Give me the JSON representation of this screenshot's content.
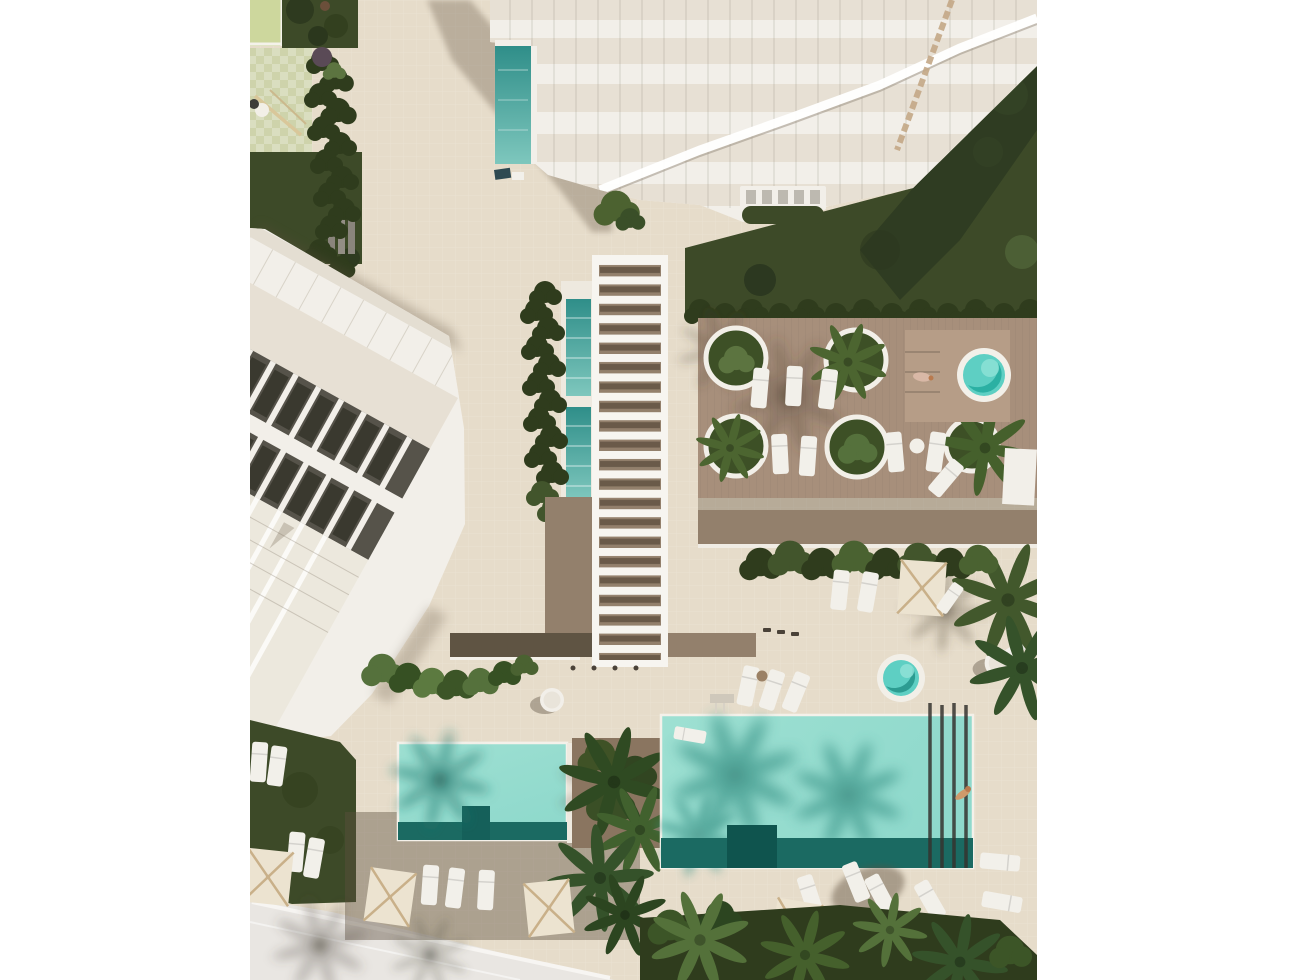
{
  "scene": {
    "type": "architectural-aerial-render",
    "description": "Top-down aerial 3D rendering of a coastal residential resort complex: a white high-rise tower with stepped terraces at the top, a long white row-house building on the left, a central white slatted pergola walkway flanked by two narrow lap pools and a hedge, a timber sun deck on the right with five round palm planters, sun loungers and a circular spa pool, a large turquoise main swimming pool and a smaller rectangular pool at the bottom surrounded by cream parasols, loungers, palm trees, lawns and a light street corner at the lower left. No text appears in the image.",
    "features": [
      {
        "name": "tower-building",
        "label": "White terraced high-rise tower, top of image"
      },
      {
        "name": "tower-pool",
        "label": "Narrow teal plunge pool beside tower"
      },
      {
        "name": "rowhouse-building",
        "label": "Diagonal white row-house block with dark grey roof decks, left side"
      },
      {
        "name": "pergola-walkway",
        "label": "White slatted pergola walkway, centre"
      },
      {
        "name": "lap-pools",
        "label": "Two narrow teal lap pools beside pergola",
        "count": 2
      },
      {
        "name": "wood-deck",
        "label": "Timber sun deck with round planters",
        "planter_count": 5
      },
      {
        "name": "spa-pool",
        "label": "Round spa pool on raised platform, right"
      },
      {
        "name": "kiddie-pool",
        "label": "Small round pool near main pool"
      },
      {
        "name": "main-pool",
        "label": "Large rectangular turquoise pool with lane lines, bottom centre"
      },
      {
        "name": "small-pool",
        "label": "Smaller rectangular turquoise pool, bottom left"
      },
      {
        "name": "umbrellas",
        "label": "Cream square parasols",
        "count": 5
      },
      {
        "name": "playground-area",
        "label": "Pale green playground with equipment, top left"
      },
      {
        "name": "garden-lawns",
        "label": "Dark green lawns and hedges"
      },
      {
        "name": "palm-trees",
        "label": "Scattered palm trees and planting beds"
      },
      {
        "name": "street",
        "label": "Light paved street corner, bottom left"
      },
      {
        "name": "sunbather",
        "label": "Person lying on the timber deck"
      },
      {
        "name": "swimmer",
        "label": "Person floating in the main pool"
      }
    ]
  },
  "palette": {
    "page_bg": "#ffffff",
    "paving": "#e6dcca",
    "street": "#e9e6e2",
    "lawn_dark": "#3d4a28",
    "lawn_light": "#53683a",
    "hedge": "#2f3c1d",
    "bush_light": "#6a8a4a",
    "playground": "#ced3ab",
    "canopy_green": "#cdd79d",
    "deck_wood": "#a78f7b",
    "boardwalk_dark": "#5f5443",
    "boardwalk_light": "#93806c",
    "spa_platform": "#b69d87",
    "pool_teal": "#8fd9cc",
    "pool_teal_light": "#9ee0d2",
    "pool_teal_dark": "#1b6a62",
    "pool_shadow_teal": "#3a9488",
    "lap_pool_top": "#2f8e89",
    "lap_pool": "#7ec7bd",
    "spa_water": "#5ecfc3",
    "white_struct": "#f2efe9",
    "glass": "#e7e0d4",
    "dark_roof": "#56534a",
    "window_dark": "#3a392f",
    "umbrella": "#ece3d0",
    "umbrella_frame": "#c9b089",
    "lounger": "#f2f0ea",
    "wood_trim": "#c4a887",
    "soil": "#8a7560",
    "shadow": "#5e4f3d"
  }
}
